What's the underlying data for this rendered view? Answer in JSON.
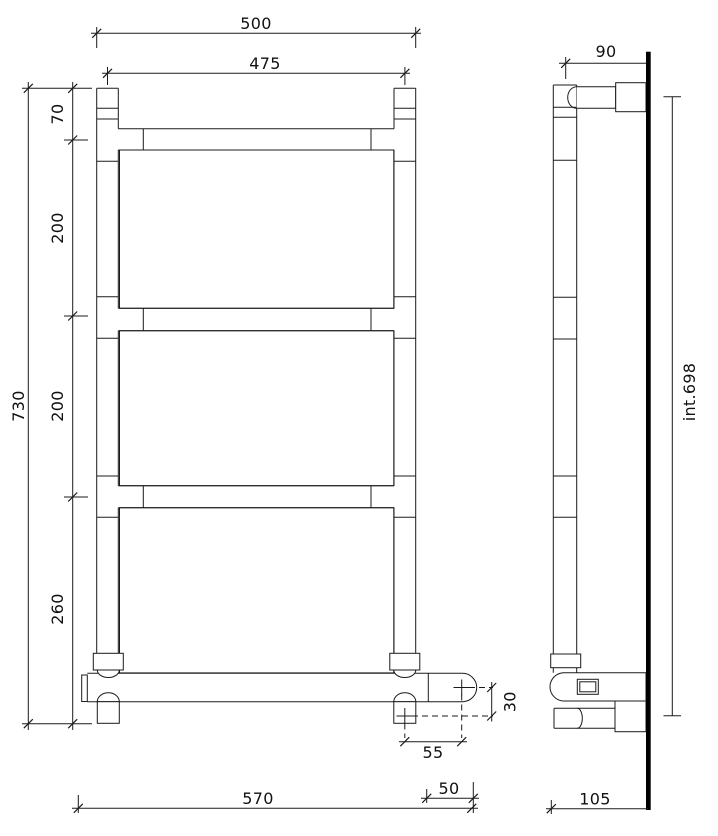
{
  "front_view": {
    "label_width_overall": "500",
    "label_width_centers": "475",
    "label_offset_top": "70",
    "label_pitch_mid_1": "200",
    "label_pitch_mid_2": "200",
    "label_offset_bottom": "260",
    "label_height_overall": "730",
    "label_bottom_rail_length": "570",
    "label_outlet_horizontal": "55",
    "label_end_section": "50",
    "label_outlet_vertical": "30"
  },
  "side_view": {
    "label_wall_distance": "90",
    "label_centres_interaxis": "int.698",
    "label_depth": "105"
  }
}
